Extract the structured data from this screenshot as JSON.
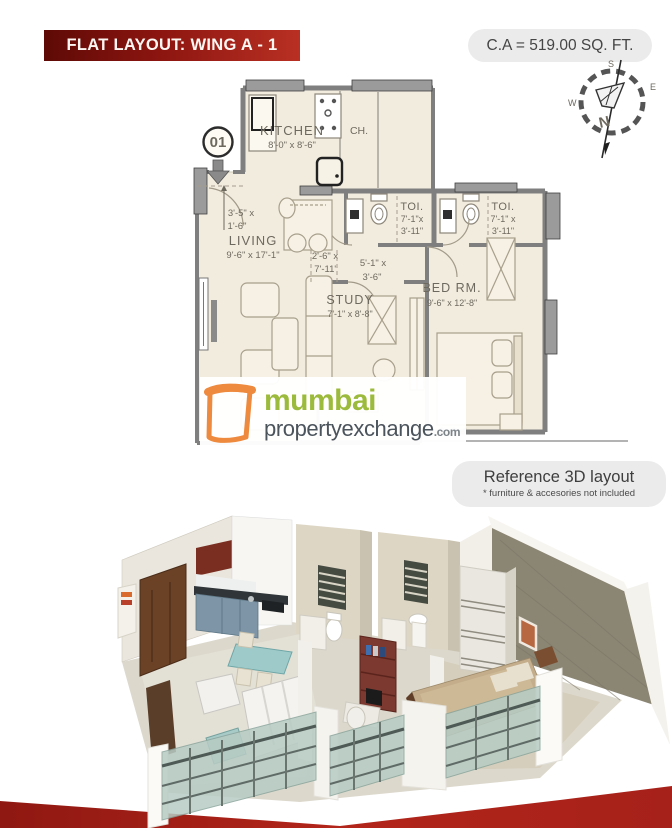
{
  "header": {
    "banner_title": "FLAT LAYOUT: WING A - 1",
    "carpet_area": "C.A = 519.00 SQ. FT."
  },
  "compass": {
    "north": "N",
    "south": "S",
    "east": "E",
    "west": "W"
  },
  "floor_plan": {
    "unit_number": "01",
    "kitchen_name": "KITCHEN",
    "kitchen_dims": "8'-0\" x 8'-6\"",
    "duct_label": "CH.",
    "living_name": "LIVING",
    "living_dims": "9'-6\" x 17'-1\"",
    "study_name": "STUDY",
    "study_dims": "7'-1\" x 8'-8\"",
    "bedroom_name": "BED RM.",
    "bedroom_dims": "9'-6\" x 12'-8\"",
    "toilet1_name": "TOI.",
    "toilet1_dims_line1": "7'-1\"x",
    "toilet1_dims_line2": "3'-11\"",
    "toilet2_name": "TOI.",
    "toilet2_dims_line1": "7'-1\" x",
    "toilet2_dims_line2": "3'-11\"",
    "entry_passage_line1": "3'-5\" x",
    "entry_passage_line2": "1'-6\"",
    "mid_passage_line1": "2'-6\" x",
    "mid_passage_line2": "7'-11\"",
    "hall_passage_line1": "5'-1\" x",
    "hall_passage_line2": "3'-6\""
  },
  "logo": {
    "word_primary": "mumbai",
    "word_secondary": "propertyexchange",
    "suffix": ".com"
  },
  "reference": {
    "title": "Reference 3D layout",
    "subtitle": "* furniture & accesories not included"
  },
  "colors": {
    "banner_dark": "#5e0a06",
    "banner_red": "#b93023",
    "ribbon_red": "#a6211a",
    "logo_green": "#9cba3b",
    "logo_gray": "#4c545c",
    "logo_orange": "#ee8a3e",
    "plan_background": "#f2ecdf",
    "wall_gray": "#7f7f7f",
    "accent_wall_taupe": "#8b8574"
  }
}
